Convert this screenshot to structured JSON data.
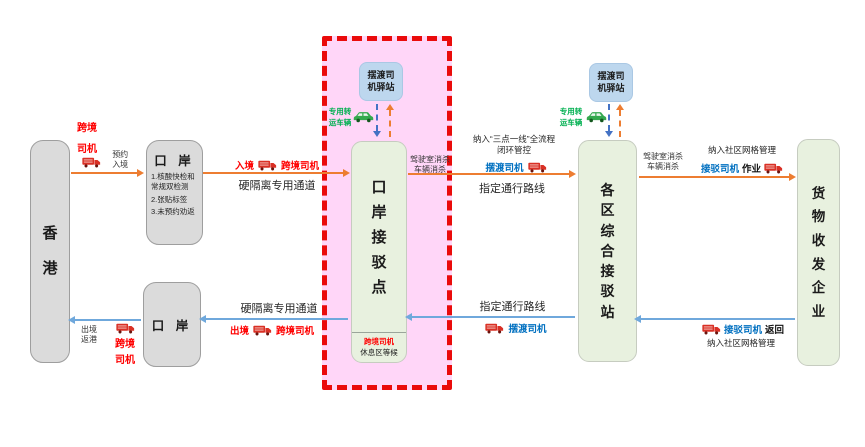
{
  "colors": {
    "forward_arrow_orange": "#ED7D31",
    "return_arrow_blue": "#6FA8DC",
    "alert_red": "#FF0000",
    "driver_blue_text": "#0070C0",
    "vehicle_green_text": "#00B050",
    "zone_pink_fill": "#FFD6F8",
    "zone_border_red": "#EA0B0B",
    "node_gray_fill": "#DBDBDB",
    "node_green_fill": "#E8F1DF",
    "station_blue_fill": "#BDD7EE"
  },
  "nodes": {
    "hongkong": {
      "label": "香港"
    },
    "port_entry": {
      "title": "口 岸",
      "items": [
        "1.核酸快检和常规双检测",
        "2.张贴标签",
        "3.未预约劝返"
      ]
    },
    "port_exit": {
      "title": "口 岸"
    },
    "connection_point": {
      "label": "口岸接驳点",
      "footer_driver": "跨境司机",
      "footer_wait": "休息区等候"
    },
    "district_station": {
      "label": "各区综合接驳站"
    },
    "cargo_enterprise": {
      "label": "货物收发企业"
    },
    "driver_station_1": {
      "label": "摆渡司机驿站"
    },
    "driver_station_2": {
      "label": "摆渡司机驿站"
    },
    "transfer_vehicle_1": {
      "label": "专用转运车辆"
    },
    "transfer_vehicle_2": {
      "label": "专用转运车辆"
    }
  },
  "flows": {
    "hk_to_port": {
      "driver": "跨境司机",
      "note": "预约入境"
    },
    "port_to_connection": {
      "entry": "入境",
      "driver": "跨境司机",
      "channel": "硬隔离专用通道"
    },
    "connection_to_district": {
      "note_line1": "纳入“三点一线”全流程",
      "note_line2": "闭环管控",
      "driver": "摆渡司机",
      "route": "指定通行路线",
      "disinfect_line1": "驾驶室消杀",
      "disinfect_line2": "车辆消杀"
    },
    "district_to_cargo": {
      "note": "纳入社区网格管理",
      "driver": "接驳司机",
      "action": "作业",
      "disinfect_line1": "驾驶室消杀",
      "disinfect_line2": "车辆消杀"
    },
    "cargo_to_district": {
      "driver": "接驳司机",
      "action": "返回",
      "note": "纳入社区网格管理"
    },
    "district_to_connection": {
      "route": "指定通行路线",
      "driver": "摆渡司机"
    },
    "connection_to_port": {
      "channel": "硬隔离专用通道",
      "exit": "出境",
      "driver": "跨境司机"
    },
    "port_to_hk": {
      "note": "出境返港",
      "driver": "跨境司机"
    }
  }
}
